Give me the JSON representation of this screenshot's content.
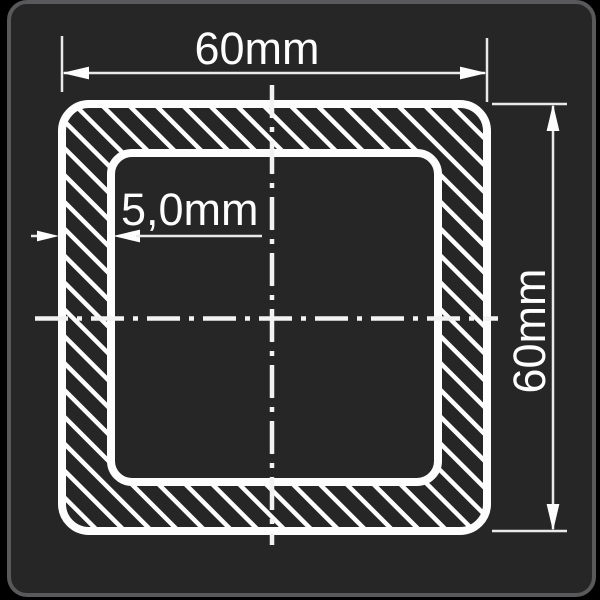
{
  "canvas": {
    "background": "#000000"
  },
  "panel": {
    "fill": "#262627",
    "border_color": "#59595b"
  },
  "drawing": {
    "line_color": "#fdfdfd",
    "thin_line_color": "#e9e9e9",
    "labels": {
      "outer_width": "60mm",
      "outer_height": "60mm",
      "wall_thickness": "5,0mm"
    }
  }
}
